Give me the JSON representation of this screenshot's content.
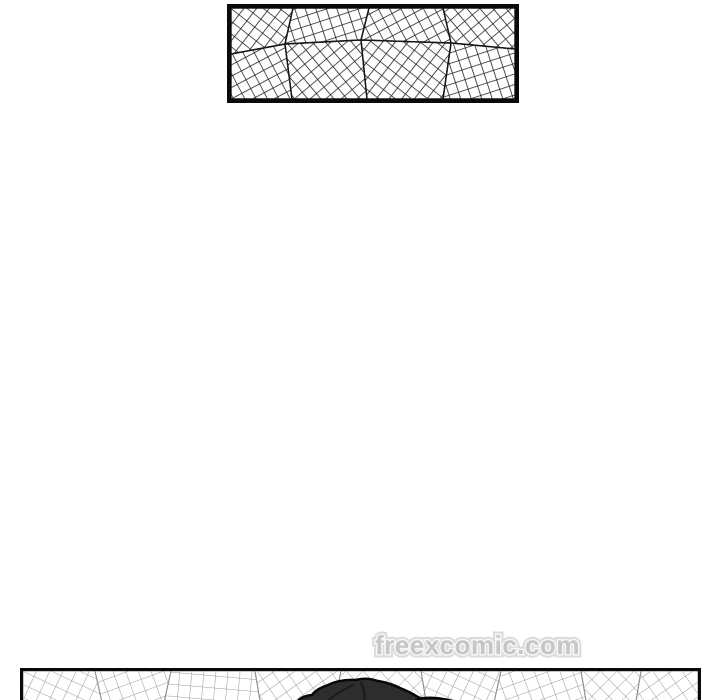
{
  "colors": {
    "page-bg": "#ffffff",
    "panel-border": "#0a0a0a",
    "mesh-dark": "#222222",
    "seam-dark": "#161616",
    "mesh-light": "#9c9c9c",
    "seam-light": "#8f8f8f",
    "watermark-fill": "#c6c6c6",
    "watermark-inner": "#f7f7f7",
    "watermark-outline": "#dcdcdc",
    "hair-fill": "#2d2d2d",
    "hair-dark": "#1a1a1a",
    "hair-outline": "#080808"
  },
  "watermark": {
    "text": "freexcomic.com"
  },
  "panels": {
    "top": {
      "label": "crosshatch-mesh-panel"
    },
    "bottom": {
      "label": "scene-panel-cropped"
    }
  }
}
